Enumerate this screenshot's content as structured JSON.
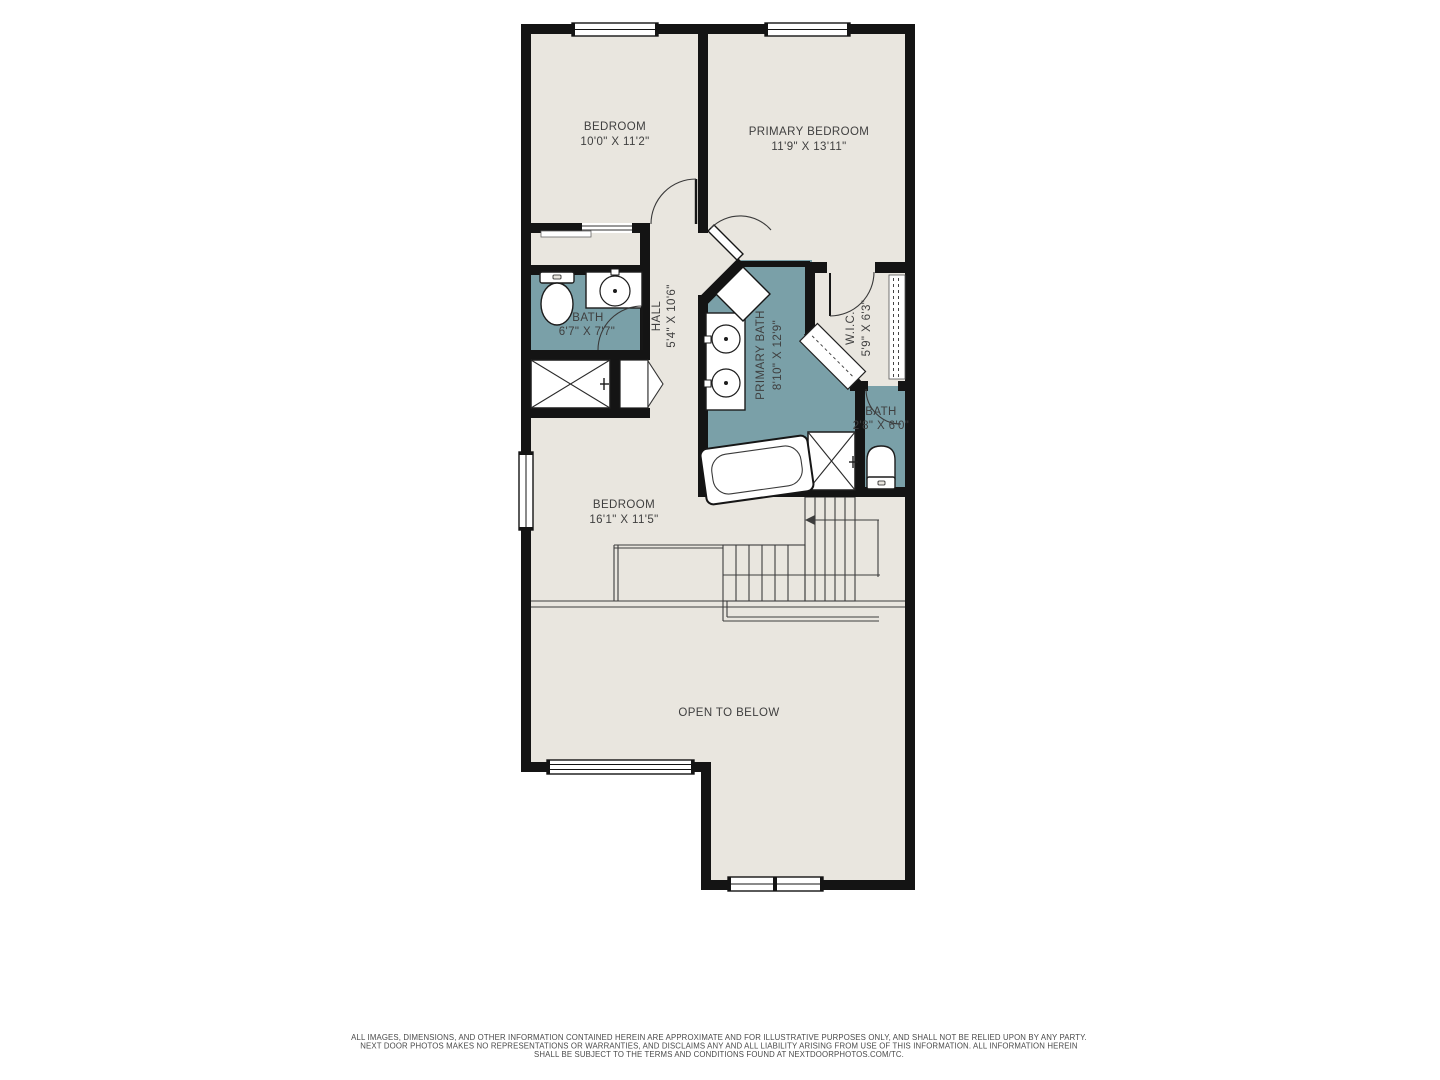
{
  "colors": {
    "floor": "#e9e6df",
    "wet_room_teal": "#7aa0a8",
    "wall_black": "#141414",
    "thin_line": "#3d3d3d",
    "label_text": "#3f3f3f"
  },
  "rooms": {
    "bedroom2": {
      "name": "BEDROOM",
      "dims": "10'0\" X 11'2\""
    },
    "primary_bedroom": {
      "name": "PRIMARY BEDROOM",
      "dims": "11'9\" X 13'11\""
    },
    "hall_bath": {
      "name": "BATH",
      "dims": "6'7\" X 7'7\""
    },
    "hall": {
      "name": "HALL",
      "dims": "5'4\" X 10'6\""
    },
    "primary_bath": {
      "name": "PRIMARY BATH",
      "dims": "8'10\" X 12'9\""
    },
    "wic": {
      "name": "W.I.C.",
      "dims": "5'9\" X 6'3\""
    },
    "water_closet": {
      "name": "BATH",
      "dims": "2'8\" X 6'0\""
    },
    "bedroom3": {
      "name": "BEDROOM",
      "dims": "16'1\" X 11'5\""
    },
    "open_to_below": {
      "name": "OPEN TO BELOW"
    }
  },
  "disclaimer": {
    "line1": "ALL IMAGES, DIMENSIONS, AND OTHER INFORMATION CONTAINED HEREIN ARE APPROXIMATE AND FOR ILLUSTRATIVE PURPOSES ONLY, AND SHALL NOT BE RELIED UPON BY ANY PARTY.",
    "line2": "NEXT DOOR PHOTOS MAKES NO REPRESENTATIONS OR WARRANTIES, AND DISCLAIMS ANY AND ALL LIABILITY ARISING FROM USE OF THIS INFORMATION. ALL INFORMATION HEREIN",
    "line3": "SHALL BE SUBJECT TO THE TERMS AND CONDITIONS FOUND AT NEXTDOORPHOTOS.COM/TC."
  }
}
